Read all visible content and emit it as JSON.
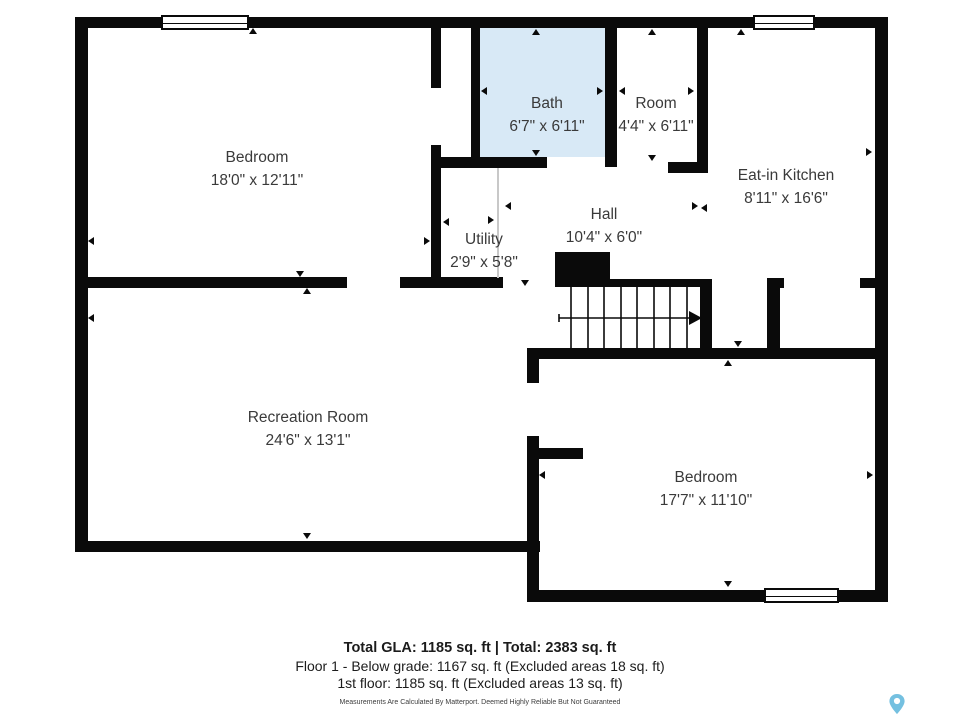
{
  "rooms": {
    "bedroom1": {
      "label": "Bedroom",
      "dims": "18'0\" x 12'11\""
    },
    "bath": {
      "label": "Bath",
      "dims": "6'7\" x 6'11\""
    },
    "room": {
      "label": "Room",
      "dims": "4'4\" x 6'11\""
    },
    "kitchen": {
      "label": "Eat-in Kitchen",
      "dims": "8'11\" x 16'6\""
    },
    "utility": {
      "label": "Utility",
      "dims": "2'9\" x 5'8\""
    },
    "hall": {
      "label": "Hall",
      "dims": "10'4\" x 6'0\""
    },
    "recreation": {
      "label": "Recreation Room",
      "dims": "24'6\" x 13'1\""
    },
    "bedroom2": {
      "label": "Bedroom",
      "dims": "17'7\" x 11'10\""
    }
  },
  "footer": {
    "totals": "Total GLA: 1185 sq. ft | Total: 2383 sq. ft",
    "floor1": "Floor 1 - Below grade: 1167 sq. ft (Excluded areas 18 sq. ft)",
    "first_floor": "1st floor: 1185 sq. ft (Excluded areas 13 sq. ft)",
    "disclaimer": "Measurements Are Calculated By Matterport. Deemed Highly Reliable But Not Guaranteed"
  },
  "colors": {
    "wall": "#0a0a0a",
    "bath_fill": "#d8e9f6",
    "pin": "#74c0e0"
  }
}
